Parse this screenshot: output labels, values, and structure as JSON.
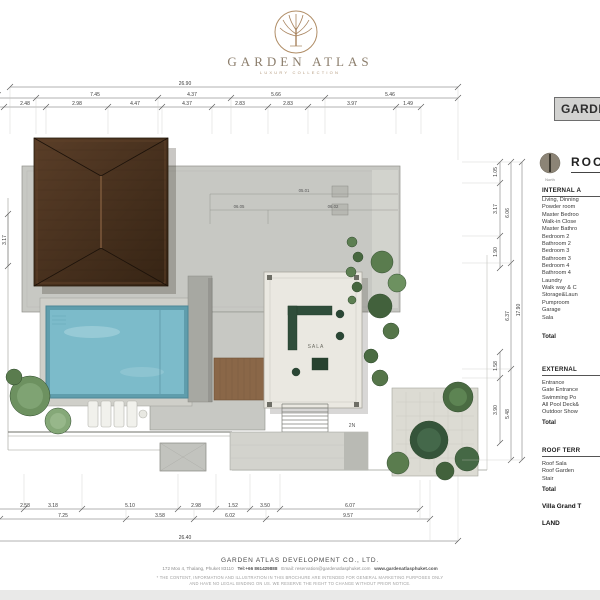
{
  "brand": {
    "name": "GARDEN ATLAS",
    "tagline": "LUXURY COLLECTION",
    "company": "GARDEN ATLAS DEVELOPMENT CO., LTD.",
    "address": "172 Moo 4, Thalang, Phuket 83110",
    "tel": "Tel:+66 861429888",
    "email": "Email: reservation@gardenatlasphuket.com",
    "website": "www.gardenatlasphuket.com",
    "disclaimer_line1": "* THE CONTENT, INFORMATION AND ILLUSTRATION IN THIS BROCHURE ARE INTENDED FOR GENERAL MARKETING PURPOSES ONLY",
    "disclaimer_line2": "AND HAVE NO LEGAL BINDING ON US. WE RESERVE THE RIGHT TO CHANGE WITHOUT PRIOR NOTICE."
  },
  "panel": {
    "title_box": "GARDEN",
    "plan_title": "ROOF",
    "north_label": "North",
    "internal": {
      "header": "INTERNAL A",
      "items": [
        "Living, Dinning",
        "Powder room",
        "Master Bedroo",
        "Walk-in Close",
        "Master Bathro",
        "Bedroom 2",
        "Bathroom 2",
        "Bedroom 3",
        "Bathroom 3",
        "Bedroom 4",
        "Bathroom 4",
        "Laundry",
        "Walk way & C",
        "Storage&Laun",
        "Pumproom",
        "Garage",
        "Sala"
      ],
      "total": "Total"
    },
    "external": {
      "header": "EXTERNAL",
      "items": [
        "Entrance",
        "Gate Entrance",
        "Swimming Po",
        "All Pool Deck&",
        "Outdoor Show"
      ],
      "total": "Total"
    },
    "roof_terrace": {
      "header": "ROOF TERR",
      "items": [
        "Roof Sala",
        "Roof Garden",
        "Stair"
      ],
      "total": "Total"
    },
    "grand_total": "Villa Grand T",
    "land": "LAND"
  },
  "plan": {
    "sala_label": "SALA",
    "stair_label": "2N",
    "tags": {
      "t1": "05.01",
      "t2": "06.05",
      "t3": "06.02"
    },
    "dims": {
      "top_overall": "26.90",
      "top_row2": [
        "3.97",
        "7.45",
        "4.37",
        "5.66",
        "5.46"
      ],
      "top_row3": [
        "2.48",
        "2.98",
        "4.47",
        "4.37",
        "2.83",
        "2.83",
        "3.97",
        "1.49"
      ],
      "left_side": "3.17",
      "bottom_row1": [
        "2.58",
        "3.18",
        "5.10",
        "2.98",
        "1.52",
        "3.50",
        "6.07"
      ],
      "bottom_row2": [
        "7.25",
        "3.58",
        "6.02",
        "9.57"
      ],
      "bottom_overall": "26.40",
      "right_inner": [
        "1.05",
        "3.17",
        "1.90",
        "1.58",
        "3.90"
      ],
      "right_mid": [
        "6.06",
        "6.37",
        "5.48"
      ],
      "right_overall": "17.90"
    }
  },
  "colors": {
    "brand_bronze": "#a8835e",
    "roof_brown": "#46301f",
    "pool_blue": "#7cbbca",
    "concrete": "#c7c8c3",
    "marble": "#eae8e1",
    "garden_green": "#4a6b42",
    "panel_box": "#d2d2d0"
  }
}
